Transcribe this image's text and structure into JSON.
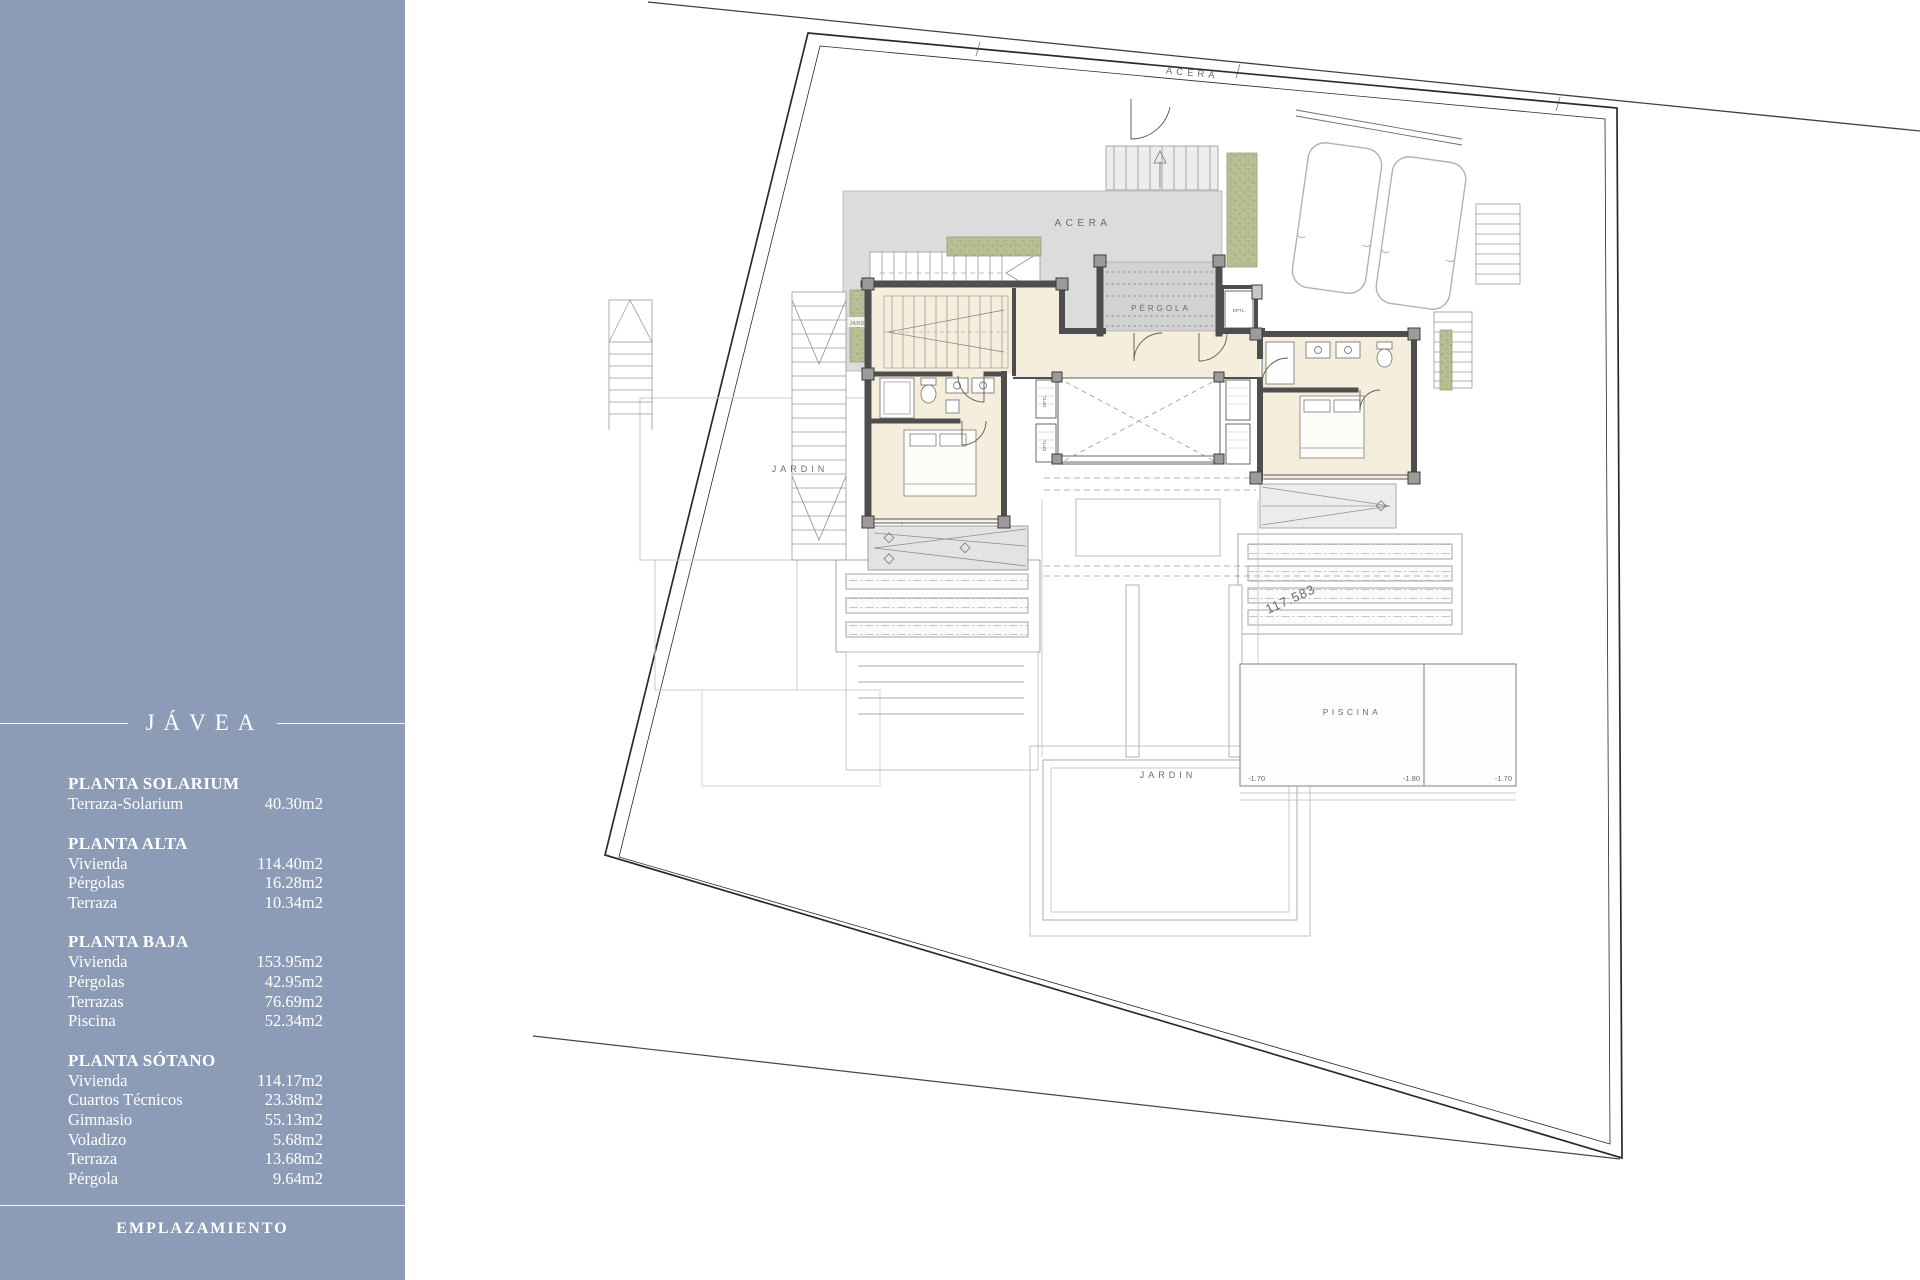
{
  "sidebar": {
    "title": "JÁVEA",
    "footer": "EMPLAZAMIENTO",
    "colors": {
      "background": "#8C9CB6",
      "text": "#FFFFFF"
    },
    "sections": [
      {
        "title": "PLANTA SOLARIUM",
        "rows": [
          {
            "label": "Terraza-Solarium",
            "value": "40.30m2"
          }
        ]
      },
      {
        "title": "PLANTA ALTA",
        "rows": [
          {
            "label": "Vivienda",
            "value": "114.40m2"
          },
          {
            "label": "Pérgolas",
            "value": "16.28m2"
          },
          {
            "label": "Terraza",
            "value": "10.34m2"
          }
        ]
      },
      {
        "title": "PLANTA BAJA",
        "rows": [
          {
            "label": "Vivienda",
            "value": "153.95m2"
          },
          {
            "label": "Pérgolas",
            "value": "42.95m2"
          },
          {
            "label": "Terrazas",
            "value": "76.69m2"
          },
          {
            "label": "Piscina",
            "value": "52.34m2"
          }
        ]
      },
      {
        "title": "PLANTA SÓTANO",
        "rows": [
          {
            "label": "Vivienda",
            "value": "114.17m2"
          },
          {
            "label": "Cuartos Técnicos",
            "value": "23.38m2"
          },
          {
            "label": "Gimnasio",
            "value": "55.13m2"
          },
          {
            "label": "Voladizo",
            "value": "5.68m2"
          },
          {
            "label": "Terraza",
            "value": "13.68m2"
          },
          {
            "label": "Pérgola",
            "value": "9.64m2"
          }
        ]
      }
    ]
  },
  "plan": {
    "labels": {
      "acera_street": "ACERA",
      "acera_walk": "ACERA",
      "pergola": "PÉRGOLA",
      "jardin_left": "JARDIN",
      "jardin_bottom": "JARDIN",
      "jard_small": "JARD.",
      "piscina": "PISCINA",
      "closet_entry": "DPTL.",
      "closet_hall_upper": "DPTL.",
      "closet_hall_lower": "DPTL.",
      "level_left": "-1.70",
      "level_mid": "-1.80",
      "level_right": "-1.70",
      "dim_note": "117.583"
    }
  }
}
